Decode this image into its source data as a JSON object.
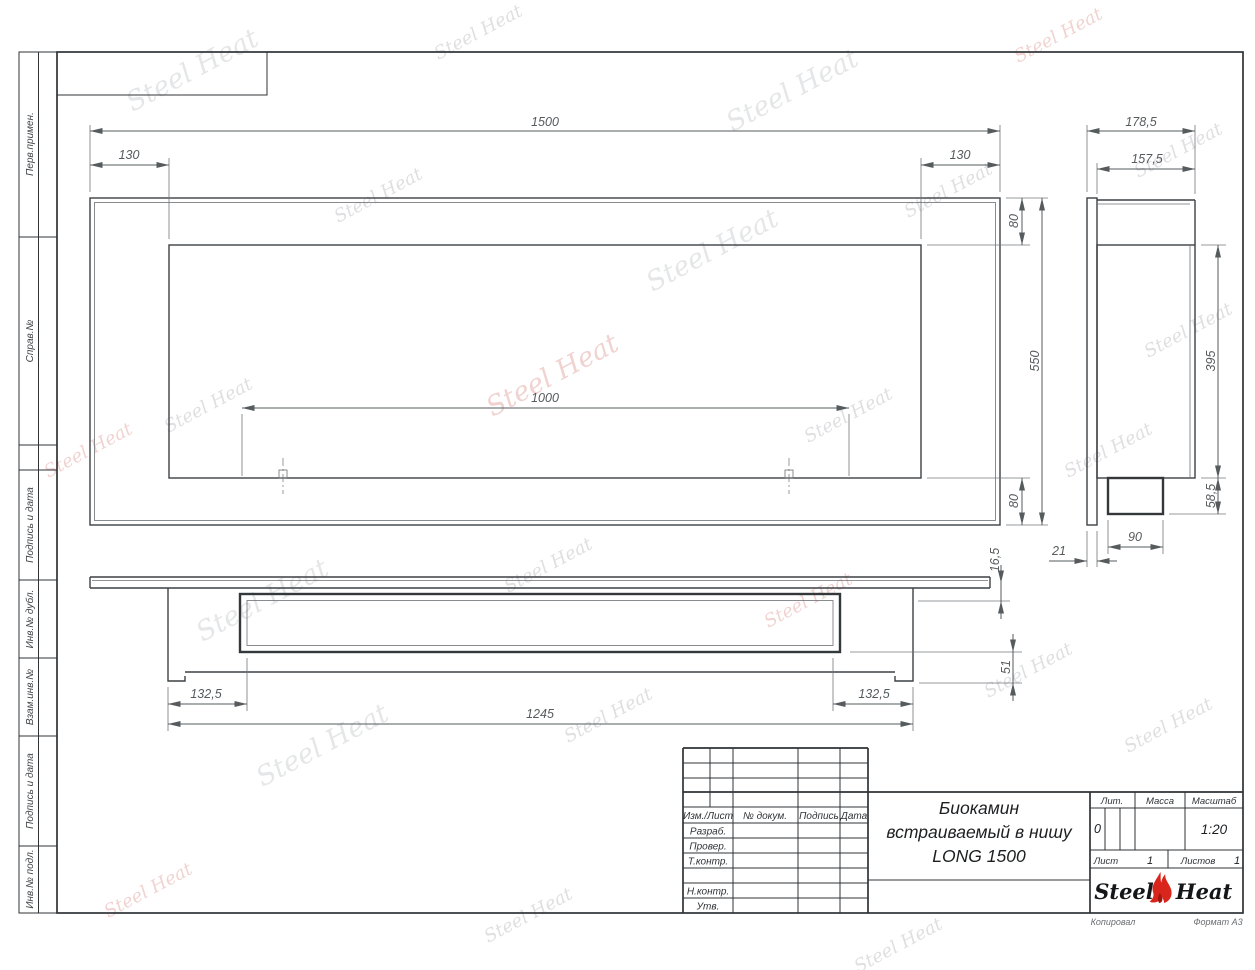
{
  "watermark": {
    "text": "Steel Heat"
  },
  "sheet": {
    "side_column_labels": [
      "Перв.примен.",
      "Справ.№",
      "Подпись и дата",
      "Инв.№ дубл.",
      "Взам.инв.№",
      "Подпись и дата",
      "Инв.№ подл."
    ],
    "footer": {
      "copied": "Копировал",
      "format": "Формат A3"
    }
  },
  "views": {
    "front": {
      "dims": {
        "width": "1500",
        "left_offset": "130",
        "right_offset": "130",
        "top_offset": "80",
        "height": "550",
        "bottom_offset": "80",
        "mount_span": "1000"
      }
    },
    "side": {
      "dims": {
        "overall_depth": "178,5",
        "body_depth": "157,5",
        "body_height": "395",
        "burner_box_height": "58,5",
        "burner_box_depth": "90",
        "flange_depth": "21"
      }
    },
    "bottom": {
      "dims": {
        "flange_thickness": "16,5",
        "under_depth": "51",
        "left_inset": "132,5",
        "body_width": "1245",
        "right_inset": "132,5"
      }
    }
  },
  "title_block": {
    "header_cells": [
      "Изм./Лист",
      "№ докум.",
      "Подпись",
      "Дата"
    ],
    "row_labels": [
      "Разраб.",
      "Провер.",
      "Т.контр.",
      "Н.контр.",
      "Утв."
    ],
    "title_lines": [
      "Биокамин",
      "встраиваемый в нишу",
      "LONG 1500"
    ],
    "lit": {
      "label": "Лит.",
      "value": "0"
    },
    "mass": {
      "label": "Масса"
    },
    "scale": {
      "label": "Масштаб",
      "value": "1:20"
    },
    "sheet_no": {
      "label": "Лист",
      "value": "1"
    },
    "sheets_total": {
      "label": "Листов",
      "value": "1"
    },
    "logo": {
      "word1": "Steel",
      "word2": "Heat"
    }
  }
}
